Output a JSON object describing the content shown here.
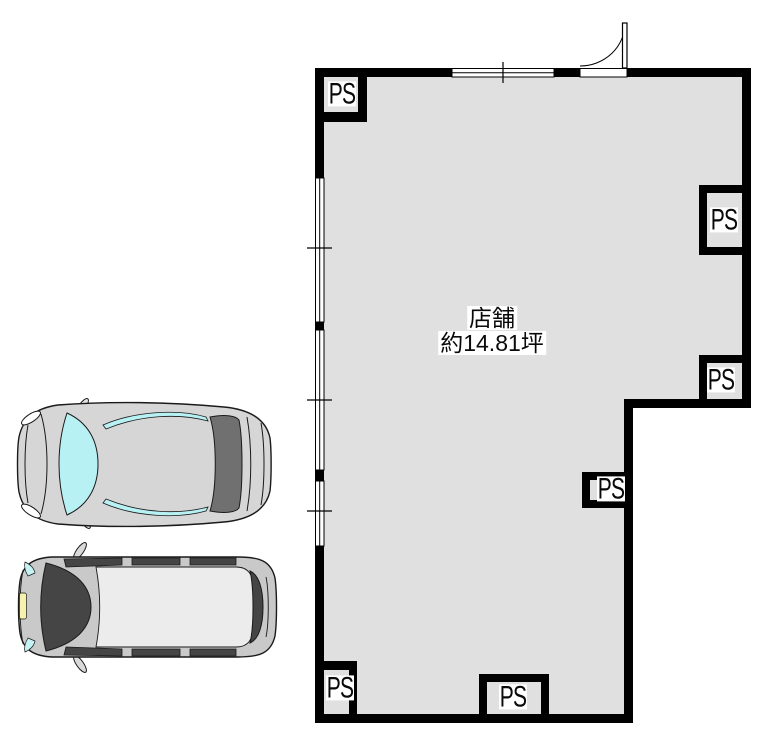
{
  "plan": {
    "room": {
      "name": "店舗",
      "area": "約14.81坪"
    },
    "ps_labels": [
      {
        "position": "top-left",
        "label": "PS"
      },
      {
        "position": "right-upper",
        "label": "PS"
      },
      {
        "position": "right-lower",
        "label": "PS"
      },
      {
        "position": "inner-middle",
        "label": "PS"
      },
      {
        "position": "bottom-left",
        "label": "PS"
      },
      {
        "position": "bottom-center",
        "label": "PS"
      }
    ],
    "colors": {
      "wall": "#000000",
      "floor": "#e0e0e0",
      "background": "#ffffff",
      "sedan_body": "#d6d6d6",
      "sedan_glass": "#b8f1f4",
      "sedan_rear_glass": "#707070",
      "van_body": "#c9c9c9",
      "van_roof": "#ececec",
      "van_glass": "#454545",
      "license_plate": "#f6f1ae"
    },
    "vehicles": [
      {
        "type": "sedan",
        "view": "top"
      },
      {
        "type": "minivan",
        "view": "top"
      }
    ]
  }
}
